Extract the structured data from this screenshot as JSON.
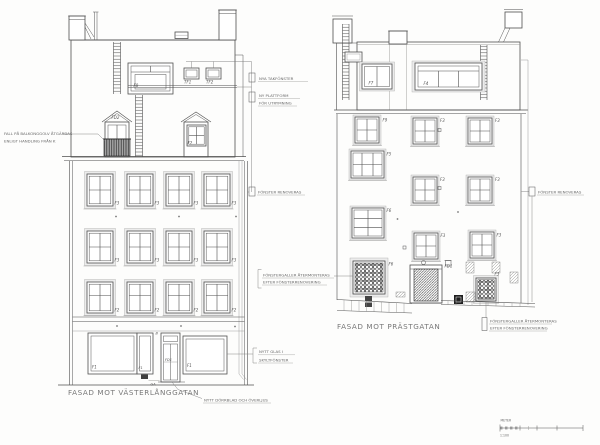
{
  "drawing": {
    "left_elevation": {
      "title": "FASAD MOT VÄSTERLÅNGGATAN",
      "window_labels": {
        "dormer_f8": "F8",
        "roof_tf1": "TF1",
        "roof_tf2": "TF2",
        "balcony_door": "FD2",
        "dormer_f2": "F2",
        "floor4": [
          "F3",
          "F3",
          "F3",
          "F3"
        ],
        "floor3": [
          "F3",
          "F3",
          "F3",
          "F3"
        ],
        "floor2": [
          "F2",
          "F2",
          "F2",
          "F2"
        ],
        "shopfront1": "F1",
        "shopfront2": "F1",
        "entrance": "FD1",
        "shopfront3": "F1",
        "gate": "GA",
        "door_b": "B"
      },
      "annotations": {
        "balcony": [
          "FALL PÅ BALKONGGOLV ÅTGÄRDAS",
          "ENLIGT HANDLING FRÅN K"
        ],
        "roof_windows": "NYA TAKFÖNSTER",
        "platform": [
          "NY PLATTFORM",
          "FÖR UTRYMNING"
        ],
        "windows": "FÖNSTER RENOVERAS",
        "shop_glass": [
          "NYTT GLAS I",
          "SKYLTFÖNSTER"
        ],
        "door": "NYTT DÖRRBLAD OCH ÖVERLJUS"
      }
    },
    "right_elevation": {
      "title": "FASAD MOT PRÄSTGATAN",
      "window_labels": {
        "roof_f7": "F7",
        "roof_f4": "F4",
        "f9": "F9",
        "floor3": [
          "F3",
          "F3"
        ],
        "f5": "F5",
        "floor2": [
          "F3",
          "F3"
        ],
        "f6": "F6",
        "floor1": [
          "F3",
          "F3"
        ],
        "grille_f6": "F6",
        "grille_f3": "F3",
        "entrance": "FD1"
      },
      "annotations": {
        "windows": "FÖNSTER RENOVERAS",
        "grille_left": [
          "FÖNSTERGALLER ÅTERMONTERAS",
          "EFTER FÖNSTERRENOVERING"
        ],
        "grille_right": [
          "FÖNSTERGALLER ÅTERMONTERAS",
          "EFTER FÖNSTERRENOVERING"
        ]
      }
    },
    "scale_bar": {
      "unit": "METER",
      "ratio": "1:100"
    }
  }
}
